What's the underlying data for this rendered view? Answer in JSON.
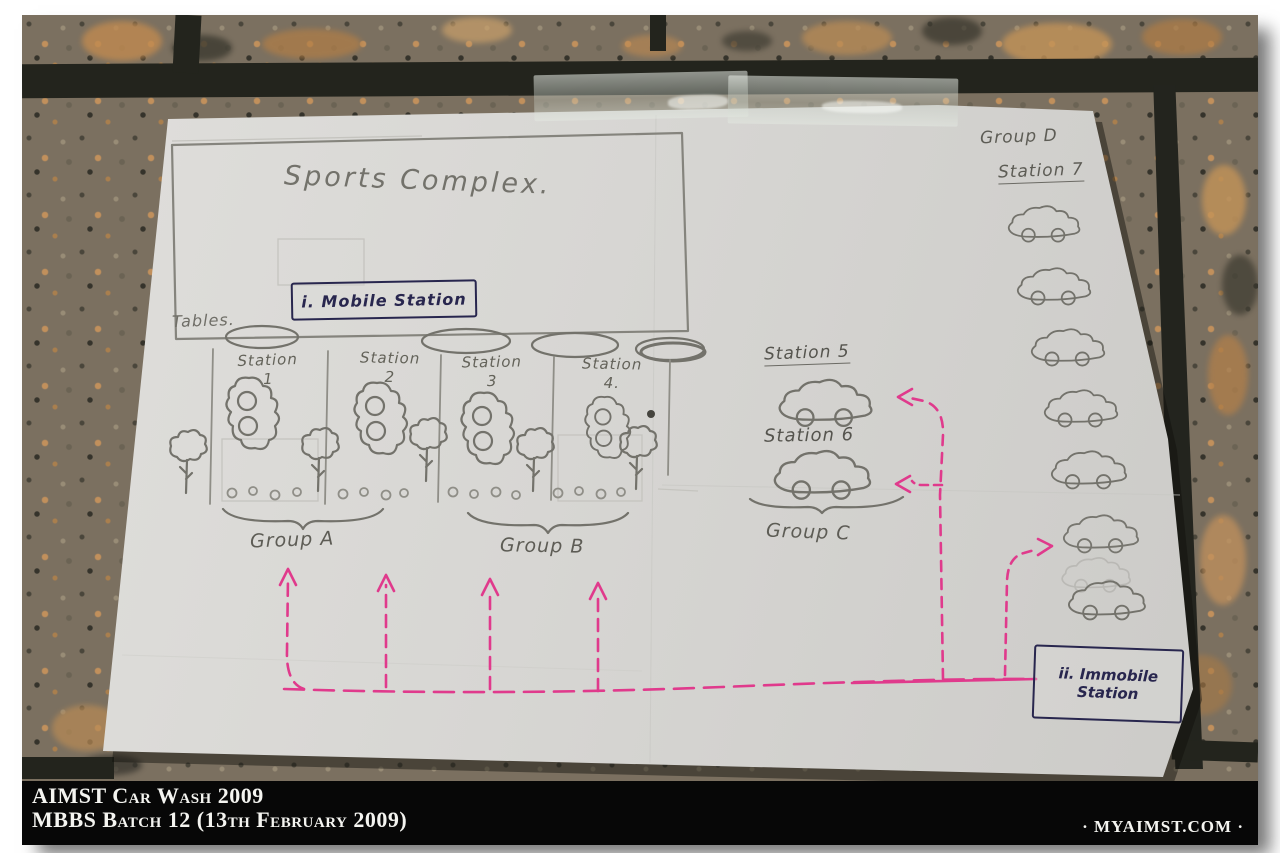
{
  "caption": {
    "line1": "AIMST Car Wash 2009",
    "line2": "MBBS Batch 12 (13th February 2009)",
    "site": "· MYAIMST.COM ·"
  },
  "sketch": {
    "title": "Sports Complex.",
    "tables_label": "Tables.",
    "mobile_station_label": "i. Mobile Station",
    "immobile_station_line1": "ii. Immobile",
    "immobile_station_line2": "Station",
    "stations": [
      {
        "label": "Station",
        "number": "1"
      },
      {
        "label": "Station",
        "number": "2"
      },
      {
        "label": "Station",
        "number": "3"
      },
      {
        "label": "Station",
        "number": "4."
      }
    ],
    "station5_label": "Station 5",
    "station6_label": "Station 6",
    "station7_label": "Station 7",
    "groups": {
      "a": "Group A",
      "b": "Group B",
      "c": "Group C",
      "d": "Group D"
    },
    "station7_car_count": 7
  },
  "colors": {
    "pencil": "#6f6e67",
    "ink_blue": "#28264e",
    "marker_pink": "#e03a8c",
    "paper": "#d8d7d4",
    "caption_bg": "#070707",
    "caption_text": "#f4f4f0"
  }
}
